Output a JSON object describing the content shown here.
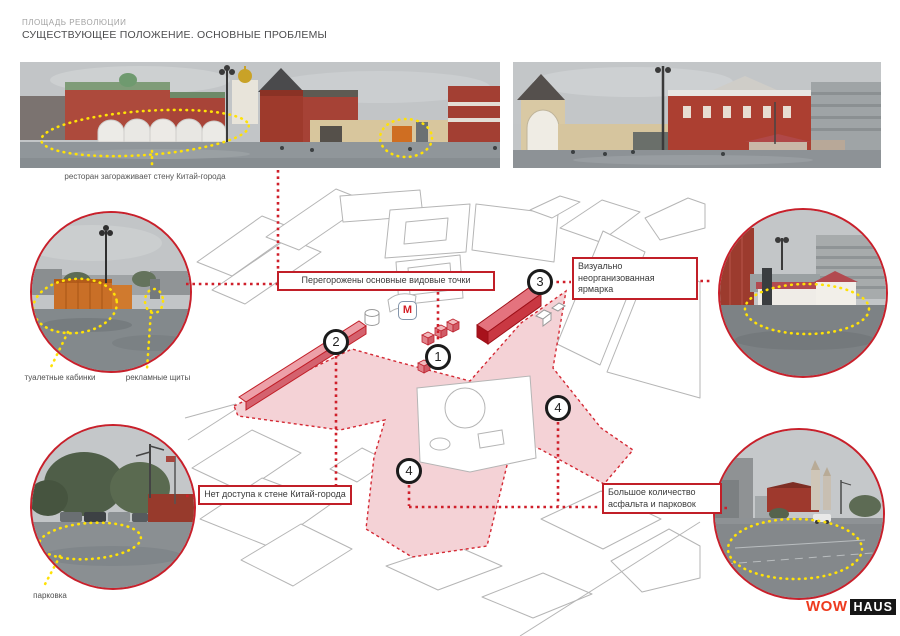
{
  "header": {
    "project": "ПЛОЩАДЬ РЕВОЛЮЦИИ",
    "title": "СУЩЕСТВУЮЩЕЕ ПОЛОЖЕНИЕ. ОСНОВНЫЕ ПРОБЛЕМЫ"
  },
  "panorama_caption": "ресторан загораживает стену Китай-города",
  "problem_labels": {
    "p1": "Перегорожены основные видовые точки",
    "p2": "Визуально неорганизованная ярмарка",
    "p3": "Нет доступа к стене Китай-города",
    "p4": "Большое количество асфальта и парковок"
  },
  "photo_labels": {
    "toilets": "туалетные кабинки",
    "billboards": "рекламные щиты",
    "parking": "парковка"
  },
  "markers": {
    "m1": "1",
    "m2": "2",
    "m3": "3",
    "m4a": "4",
    "m4b": "4"
  },
  "metro_label": "М",
  "logo": {
    "wow": "WOW",
    "haus": "HAUS"
  },
  "colors": {
    "accent_red": "#C21B26",
    "zone_pink": "#F4D2D6",
    "highlight_yellow": "#FFE100"
  }
}
